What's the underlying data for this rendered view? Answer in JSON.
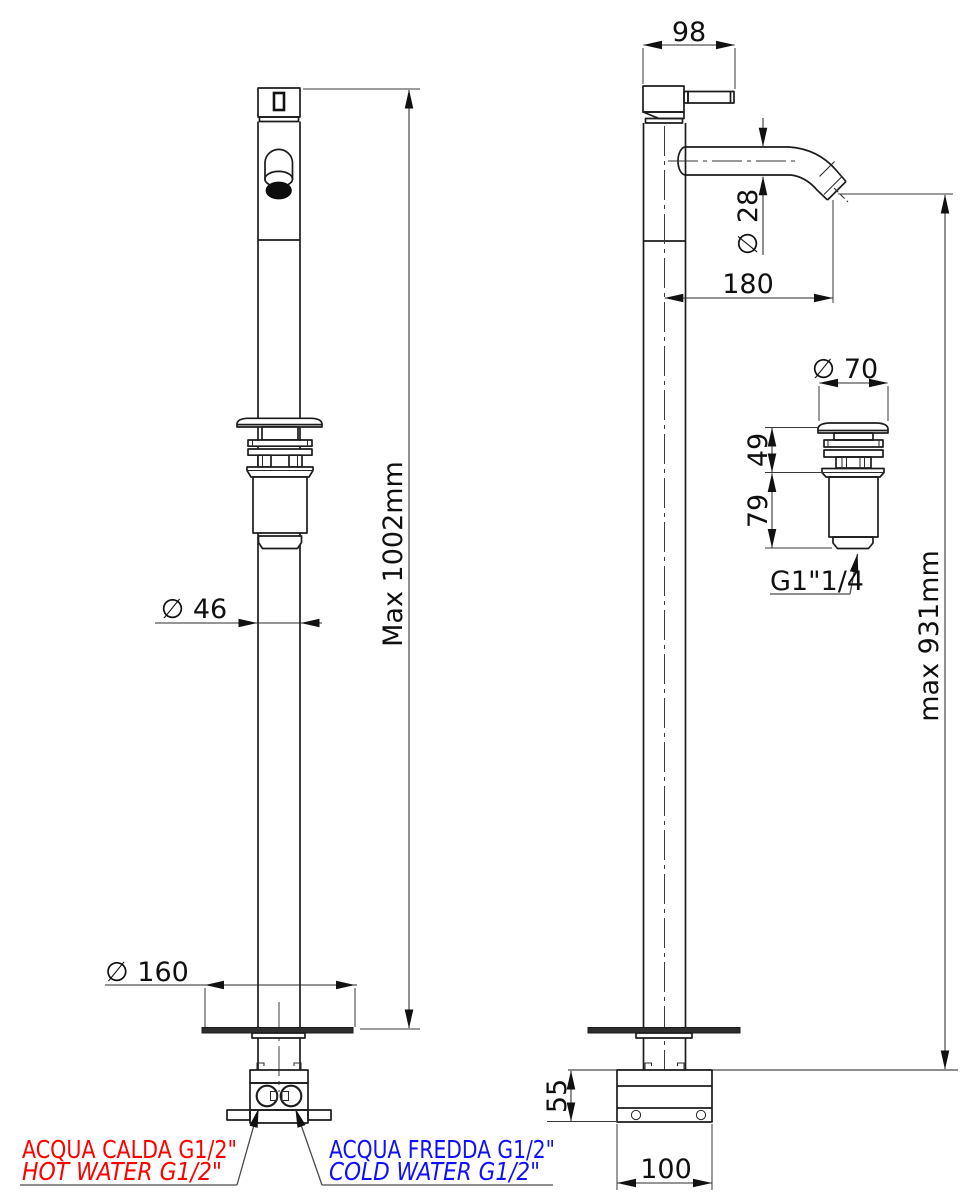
{
  "front_view": {
    "max_height": "Max 1002mm",
    "column_diameter": "∅ 46",
    "base_plate_diameter": "∅ 160"
  },
  "side_view": {
    "handle_length": "98",
    "spout_diameter": "∅ 28",
    "spout_reach": "180",
    "spout_height": "max 931mm",
    "under_floor_box_height": "55",
    "under_floor_box_width": "100"
  },
  "waste_detail": {
    "cap_diameter": "∅ 70",
    "upper_height": "49",
    "body_height": "79",
    "thread_label": "G1\"1/4"
  },
  "connections": {
    "hot": {
      "line1": "ACQUA CALDA G1/2\"",
      "line2": "HOT WATER G1/2\"",
      "color": "#fe0000"
    },
    "cold": {
      "line1": "ACQUA FREDDA G1/2\"",
      "line2": "COLD WATER G1/2\"",
      "color": "#0f0fff"
    }
  },
  "colors": {
    "line": "#1c1c1c",
    "background": "#ffffff"
  }
}
